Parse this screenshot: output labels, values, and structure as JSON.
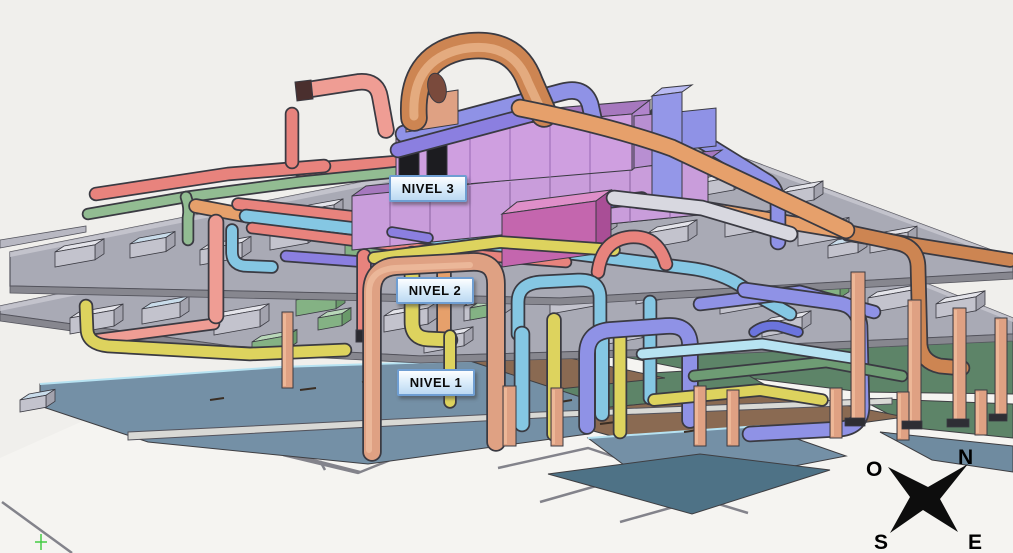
{
  "levels": [
    {
      "id": "nivel-3",
      "label": "NIVEL 3"
    },
    {
      "id": "nivel-2",
      "label": "NIVEL 2"
    },
    {
      "id": "nivel-1",
      "label": "NIVEL 1"
    }
  ],
  "compass": {
    "west": "O",
    "north": "N",
    "south": "S",
    "east": "E"
  },
  "palette": {
    "bg": "#f0efec",
    "ground": "#f5f4f1",
    "wall": "#83838b",
    "slab": "#a9aab5",
    "slabLight": "#c9c9d2",
    "slabEdge": "#53535c",
    "dark": "#3a3a42",
    "red": "#e8837d",
    "salmon": "#ef9d94",
    "orange": "#e6a06b",
    "copper": "#cd8552",
    "tan": "#dfa183",
    "yellow": "#ddd35e",
    "green": "#92bc92",
    "greenDark": "#6e9c74",
    "cyan": "#85c7e3",
    "cyanLight": "#b7e3f2",
    "periwinkle": "#8f92e6",
    "violet": "#8b7fe0",
    "blue": "#6b74dd",
    "orchid": "#c99ddb",
    "magenta": "#c466ae",
    "brown": "#8a6a52",
    "slate": "#7490a6",
    "teal": "#4e7286",
    "greenFloor": "#5d8468",
    "star": "#0d0d0d"
  }
}
